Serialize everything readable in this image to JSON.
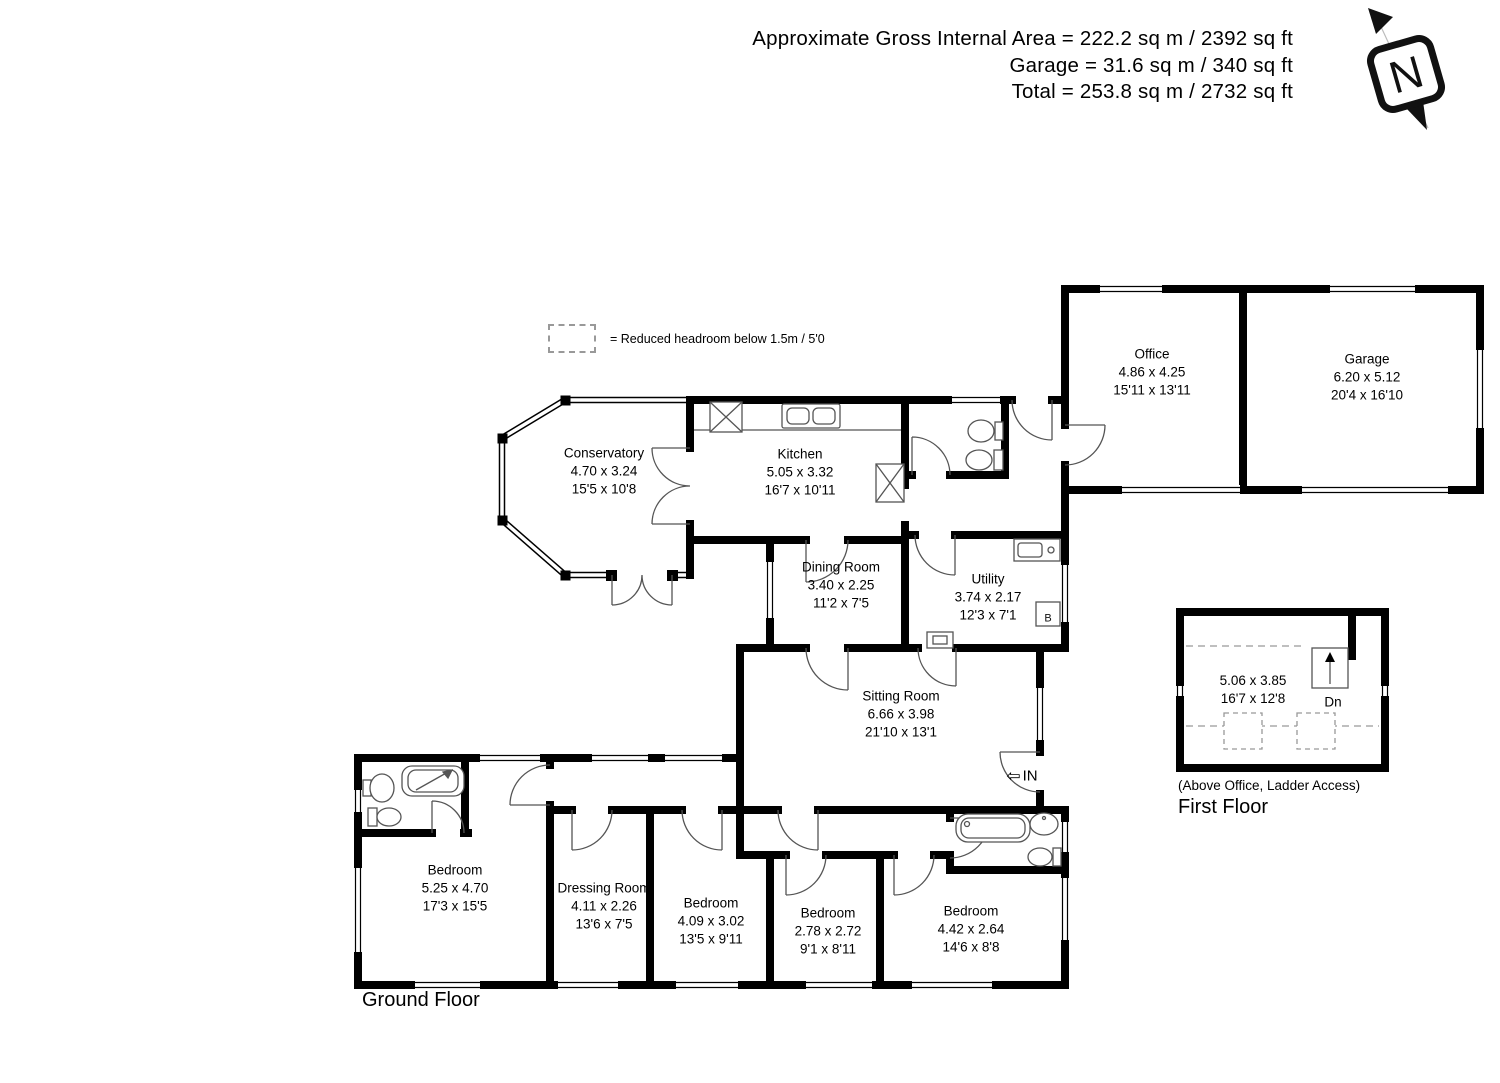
{
  "title_block": {
    "line1": "Approximate Gross Internal Area = 222.2 sq m / 2392 sq ft",
    "line2": "Garage = 31.6 sq m / 340 sq ft",
    "line3": "Total = 253.8 sq m / 2732 sq ft"
  },
  "compass": {
    "label": "N"
  },
  "legend": {
    "text": "= Reduced headroom below 1.5m / 5'0"
  },
  "rooms": [
    {
      "name": "Conservatory",
      "metric": "4.70 x 3.24",
      "imperial": "15'5 x 10'8"
    },
    {
      "name": "Kitchen",
      "metric": "5.05 x 3.32",
      "imperial": "16'7 x 10'11"
    },
    {
      "name": "Office",
      "metric": "4.86 x 4.25",
      "imperial": "15'11 x 13'11"
    },
    {
      "name": "Garage",
      "metric": "6.20 x 5.12",
      "imperial": "20'4 x 16'10"
    },
    {
      "name": "Dining Room",
      "metric": "3.40 x 2.25",
      "imperial": "11'2 x 7'5"
    },
    {
      "name": "Utility",
      "metric": "3.74 x 2.17",
      "imperial": "12'3 x 7'1"
    },
    {
      "name": "Sitting Room",
      "metric": "6.66 x 3.98",
      "imperial": "21'10 x 13'1"
    },
    {
      "name": "Bedroom",
      "metric": "5.25 x 4.70",
      "imperial": "17'3 x 15'5"
    },
    {
      "name": "Dressing Room",
      "metric": "4.11 x 2.26",
      "imperial": "13'6 x 7'5"
    },
    {
      "name": "Bedroom",
      "metric": "4.09 x 3.02",
      "imperial": "13'5 x 9'11"
    },
    {
      "name": "Bedroom",
      "metric": "2.78 x 2.72",
      "imperial": "9'1 x 8'11"
    },
    {
      "name": "Bedroom",
      "metric": "4.42 x 2.64",
      "imperial": "14'6 x 8'8"
    }
  ],
  "first_floor_room": {
    "metric": "5.06 x 3.85",
    "imperial": "16'7 x 12'8",
    "stair_label": "Dn",
    "note": "(Above Office, Ladder Access)"
  },
  "floor_titles": {
    "ground": "Ground Floor",
    "first": "First Floor"
  },
  "annotations": {
    "entrance": "IN",
    "entrance_arrow": "⇦",
    "boiler": "B"
  },
  "colors": {
    "wall": "#000000",
    "fixture_line": "#555555",
    "dashed": "#999999"
  }
}
